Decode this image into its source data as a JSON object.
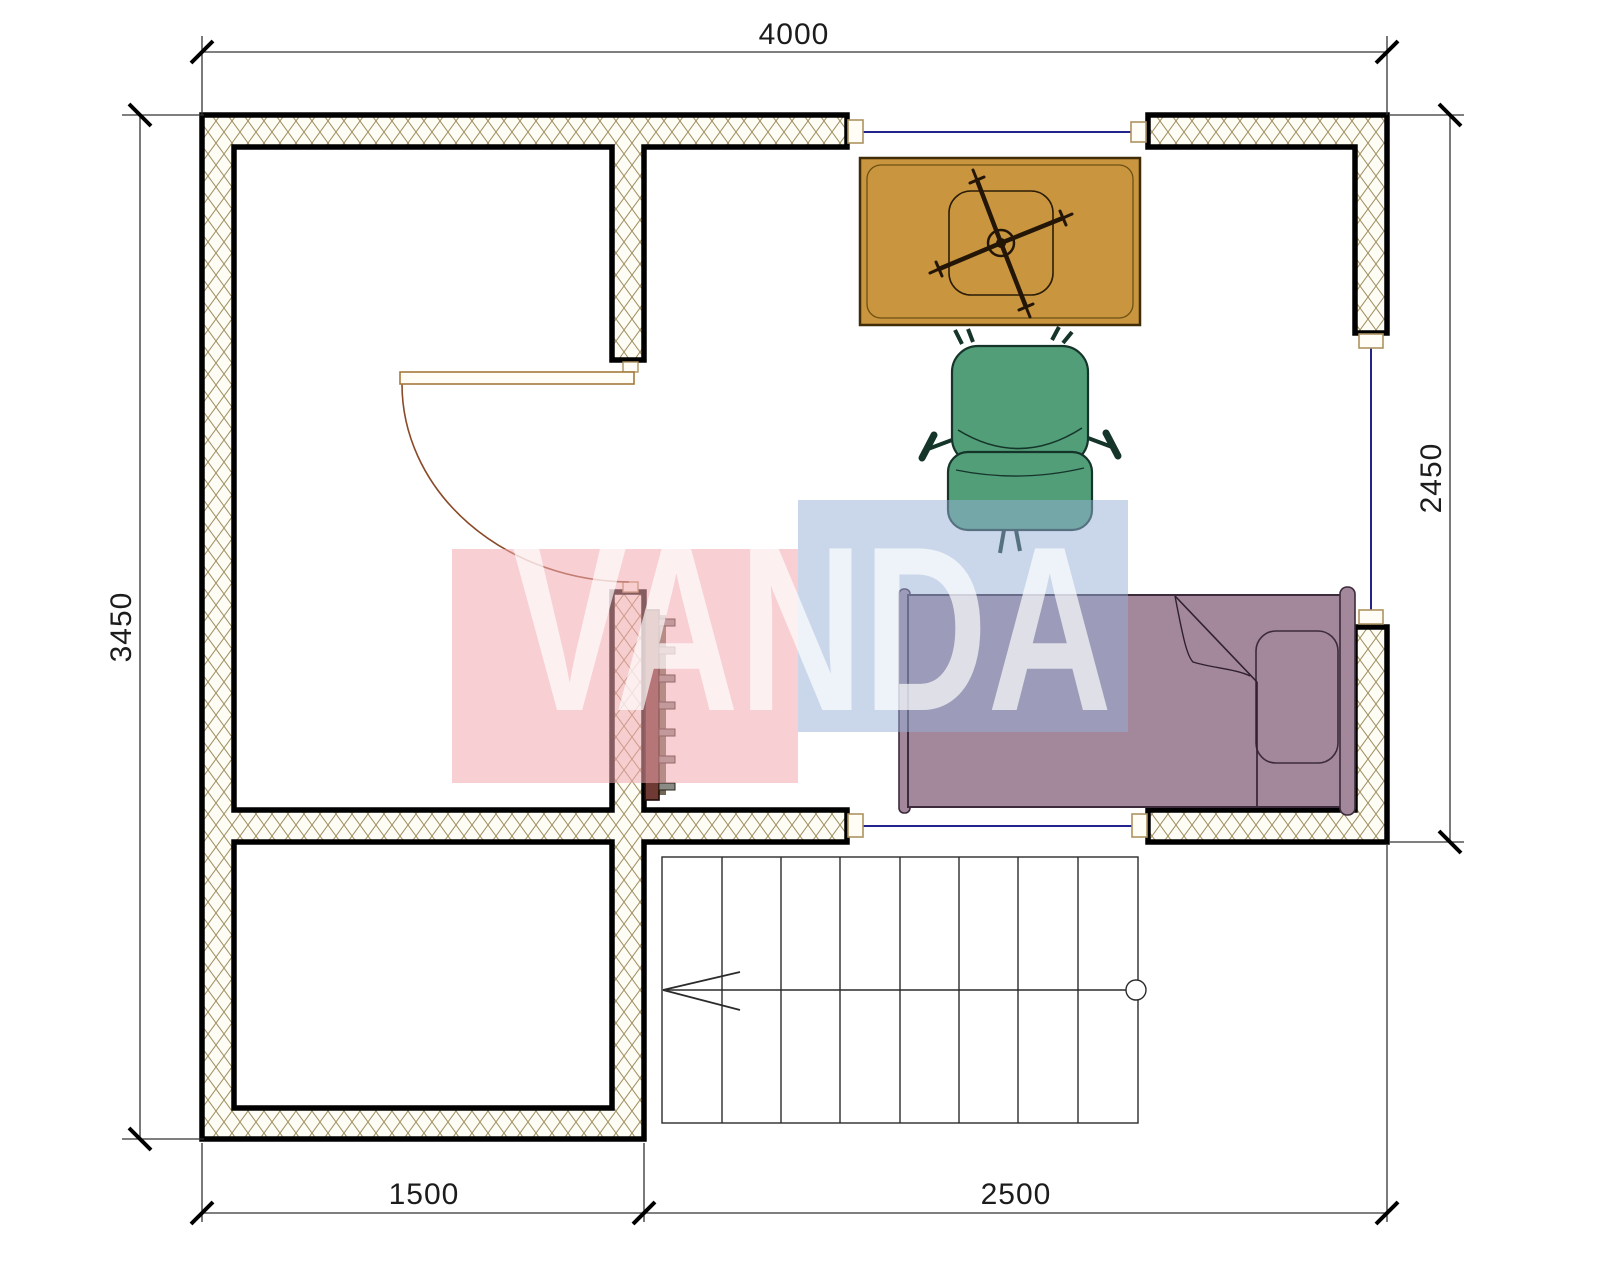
{
  "drawing": {
    "type": "floor-plan",
    "background": "#ffffff"
  },
  "dimensions": {
    "top": "4000",
    "left": "3450",
    "right": "2450",
    "bottom_left": "1500",
    "bottom_right": "2500"
  },
  "watermark": {
    "text": "VANDA",
    "pink_block": "#f2a7ae",
    "blue_block": "#96afd7"
  },
  "colors": {
    "wall_outline": "#000000",
    "hatch_line": "#a08f60",
    "hatch_fill": "#fdfcf5",
    "window_line": "#23238c",
    "jamb_stroke": "#ad9361",
    "door_arc": "#8a4a28",
    "desk": "#c9953f",
    "chair": "#529e79",
    "bed": "#a3879b",
    "radiator": "#6e3a33",
    "radiator_fin": "#8b8b85",
    "stairs_line": "#2b2b2b",
    "watermark_pink": "#f2a7ae",
    "watermark_blue": "#96afd7"
  },
  "objects": {
    "walls": "hatched-masonry-walls",
    "door": "hinged-door-with-swing-arc",
    "windows": "triple-glazing-lines",
    "desk": "writing-desk",
    "desk_chair": "swivel-chair-under-desk",
    "armchair": "office-armchair",
    "bed": "single-bed-with-pillow-and-blanket",
    "radiator": "wall-radiator",
    "stairs": "staircase-with-up-arrow"
  }
}
